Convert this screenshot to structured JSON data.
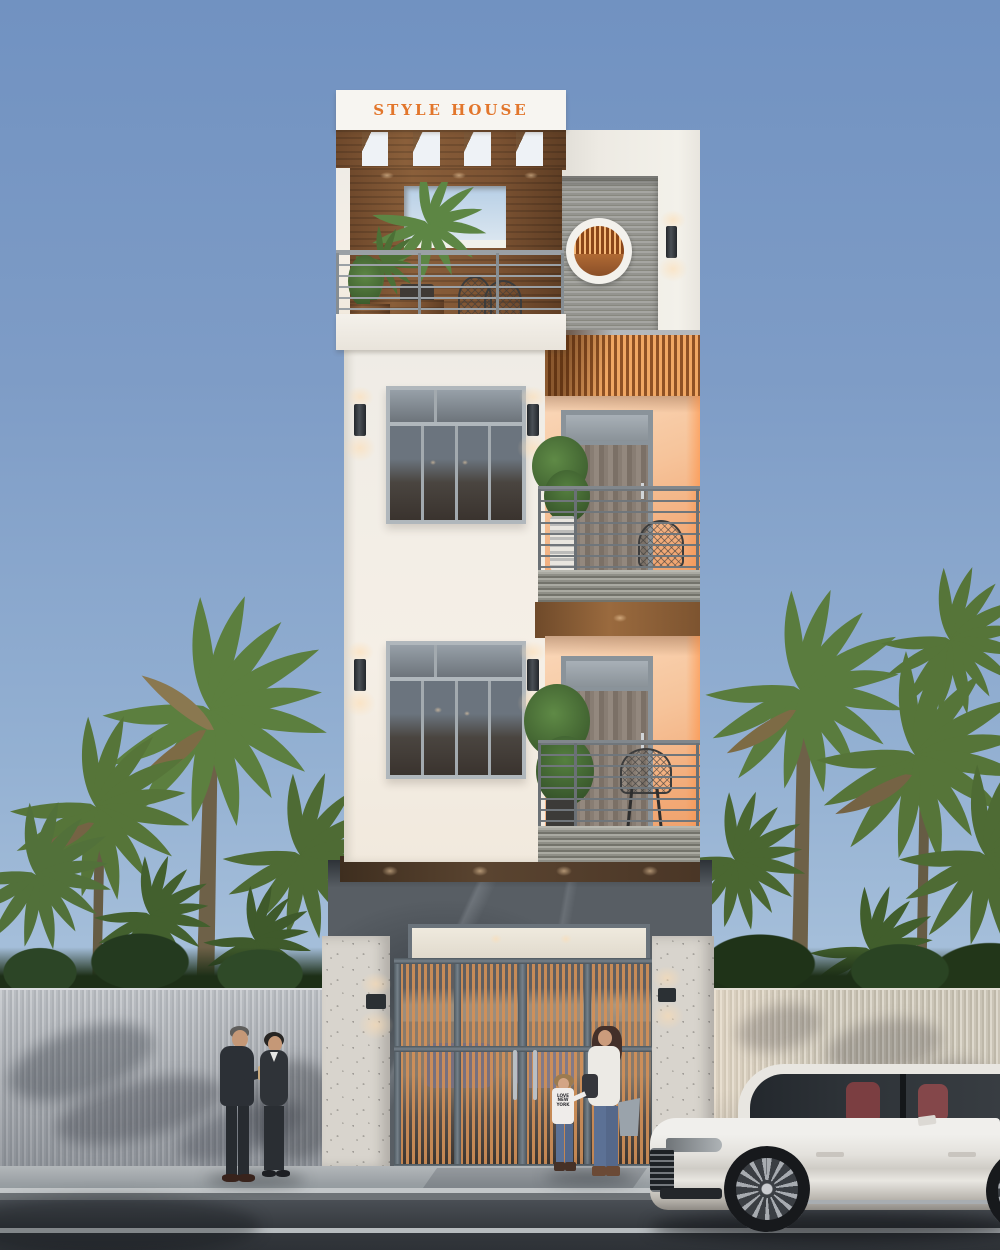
{
  "scene": {
    "type": "architectural exterior render",
    "time_of_day": "dusk",
    "description": "Front elevation 3D render of a narrow four-storey modern townhouse with a rooftop pergola terrace, two recessed balconies, marble-clad ground floor entrance, ribbed street fences, fan palm trees, pedestrians on the sidewalk and a white luxury sedan parked at the curb."
  },
  "building": {
    "sign_text": "STYLE HOUSE",
    "levels_visible": 4
  },
  "people": {
    "girl_shirt_text": "LOVE\nNEW\nYORK"
  },
  "colors": {
    "sky_top": "#7192c1",
    "sky_horizon": "#b6cadf",
    "wall_white": "#f3efe8",
    "wood_pergola": "#7b5232",
    "sign_orange": "#e2762c",
    "balcony_peach": "#f6c49b",
    "awning_orange": "#f0a763",
    "marble_dark": "#585e64",
    "ribbed_panel_gray": "#9a9a96",
    "stone_pillar": "#d8d4cd",
    "fence_left_gray": "#b2b6bb",
    "fence_right_beige": "#cac4b6",
    "railing_gray": "#6a7075",
    "door_slat_wood": "#cd8c55",
    "palm_green": "#5c7f3f",
    "sidewalk_gray": "#9aa0a4",
    "road_asphalt": "#34383d",
    "car_white": "#eae8e4",
    "car_seat_maroon": "#7b3e41"
  }
}
